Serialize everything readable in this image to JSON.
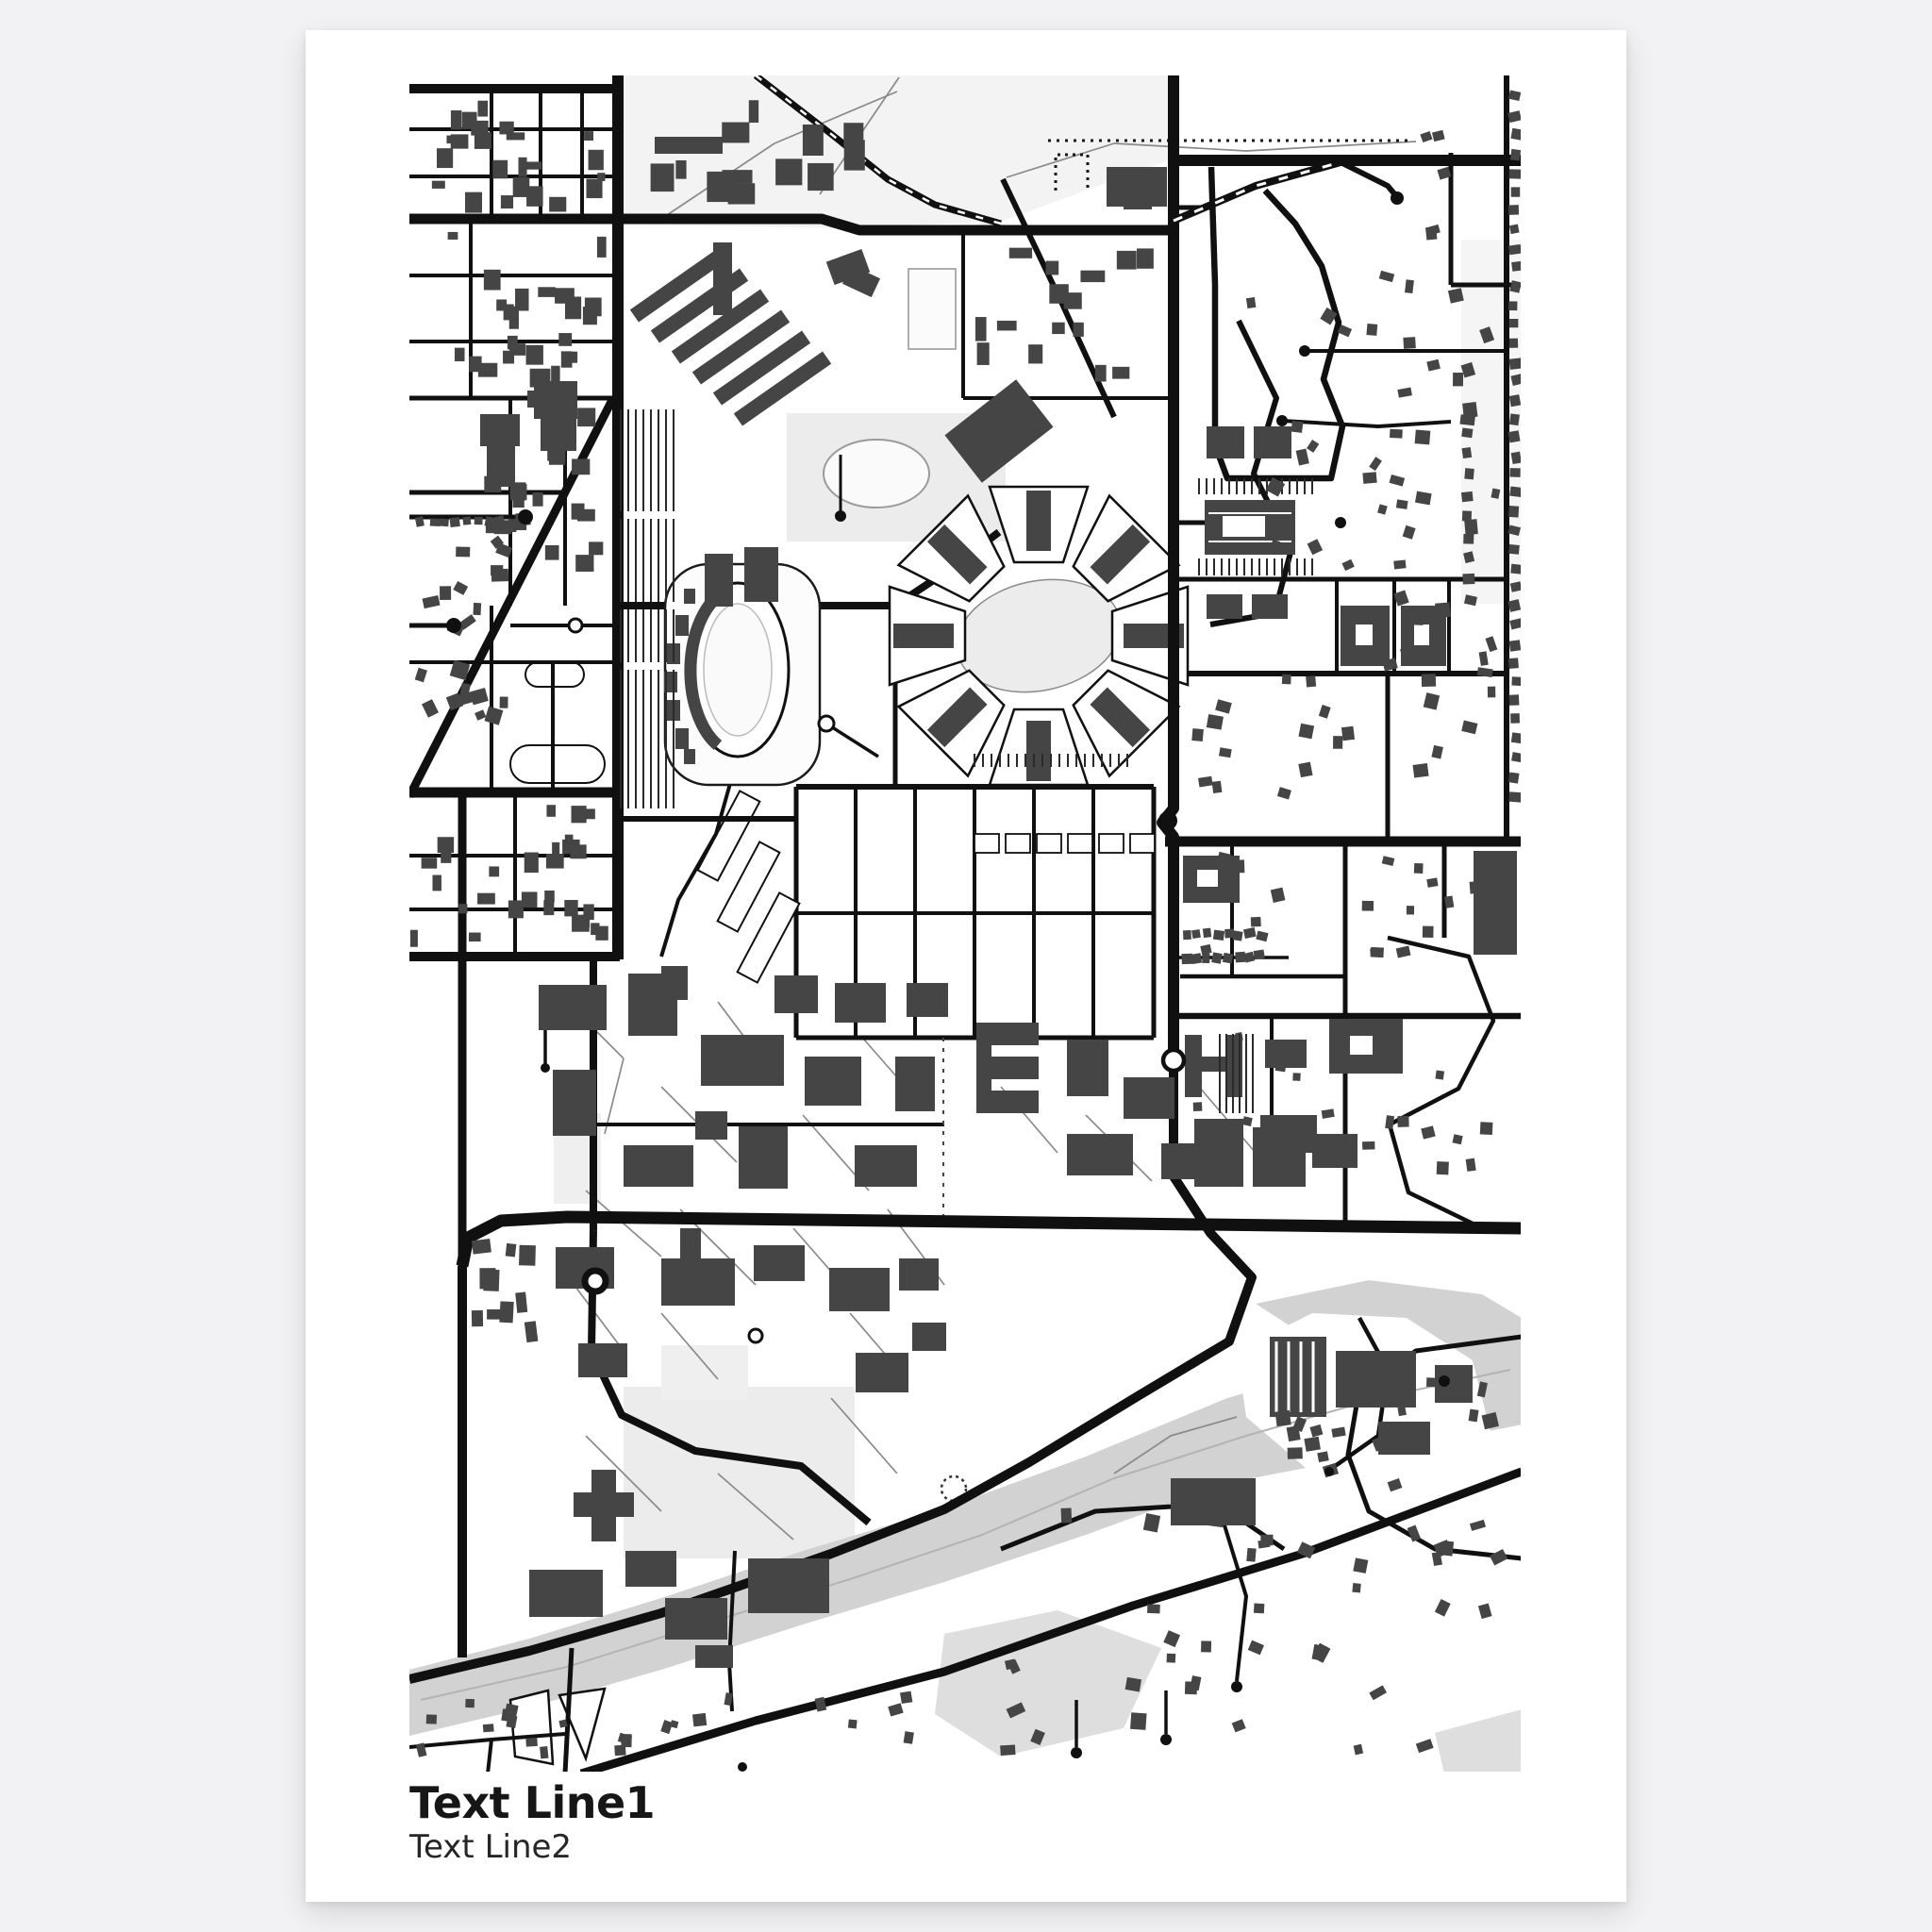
{
  "background_color": "#f2f2f4",
  "poster": {
    "color": "#ffffff",
    "caption": {
      "line1": "Text Line1",
      "line2": "Text Line2"
    }
  },
  "map": {
    "kind": "monochrome-street-map-print",
    "colors": {
      "background": "#ffffff",
      "roads": "#101010",
      "buildings": "#454545",
      "water": "#d2d2d2",
      "marsh": "#dedede",
      "park": "#f3f3f3",
      "field": "#ececec",
      "paths": "#8a8a8a",
      "channel": "#b3b3b3"
    },
    "features": [
      "street-grid",
      "university-campus",
      "stadium",
      "radial-housing-complex",
      "athletic-fields-grid",
      "river",
      "suburban-neighborhoods"
    ]
  }
}
